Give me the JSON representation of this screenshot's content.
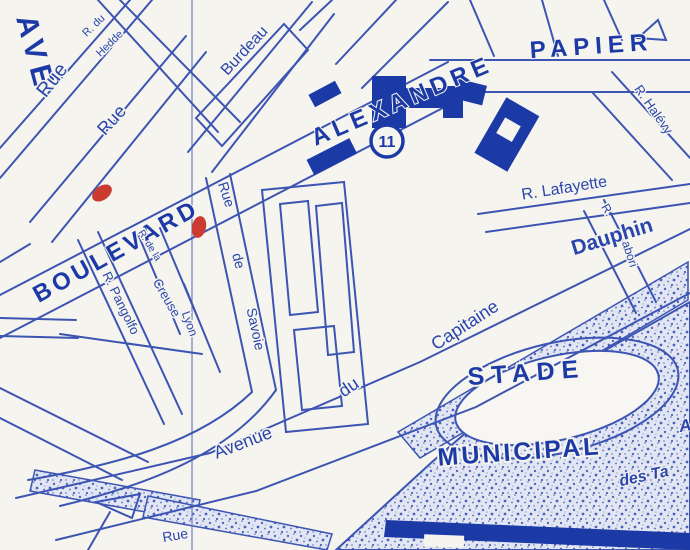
{
  "colors": {
    "paper": "#f5f4ef",
    "ink_bold": "#1c3aa6",
    "line_blue": "#3d55b2",
    "stipple_bg": "#e2e6f3",
    "stipple_dot": "#5368bb",
    "red_marker": "#cc3b2f"
  },
  "poi": {
    "badge_number": "11"
  },
  "labels": {
    "avenue_edge_partial": "AVE",
    "r_du": "R. du",
    "hedde": "Hedde",
    "rue_1": "Rue",
    "rue_2": "Rue",
    "burdeau": "Burdeau",
    "boulevard": "BOULEVARD",
    "alexandre": "ALEXANDRE",
    "papier": "PAPIER",
    "r_halevy": "R. Halévy",
    "r_lafayette": "R. Lafayette",
    "r_abbrev_labori": "R.",
    "labori": "Labori",
    "dauphin": "Dauphin",
    "capitaine": "Capitaine",
    "du": "du",
    "avenue": "Avenue",
    "rue_savoie_rue": "Rue",
    "rue_savoie_de": "de",
    "rue_savoie_savoie": "Savoie",
    "r_pangolfo": "R. Pangolfo",
    "r_de_la": "R. de la",
    "creuse": "Creuse",
    "lyon": "Lyon",
    "stade": "STADE",
    "municipal": "MUNICIPAL",
    "des_ta": "des Ta",
    "a_partial": "A",
    "rue_bottom": "Rue"
  }
}
